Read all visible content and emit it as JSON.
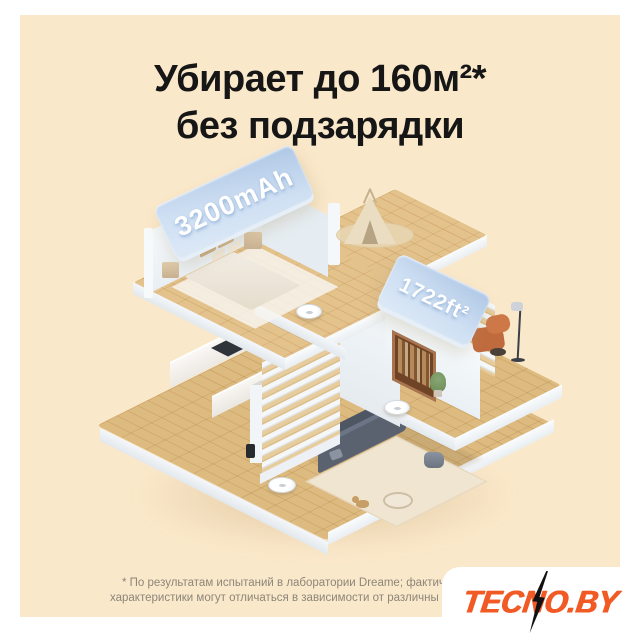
{
  "title": {
    "line1": "Убирает до 160м²*",
    "line2": "без подзарядки"
  },
  "badges": {
    "battery_label": "3200mAh",
    "area_label": "1722ft²"
  },
  "footnote": {
    "line1": "* По результатам испытаний в лаборатории Dreame; фактич",
    "line2": "характеристики могут отличаться в зависимости от различны"
  },
  "watermark": {
    "text": "TECNO.BY"
  },
  "colors": {
    "page": "#FFFFFF",
    "card_background": "#FAE8CA",
    "title_text": "#161616",
    "badge_blue_top": "#AFC7E5",
    "badge_blue_bottom": "#DCE9F7",
    "badge_text": "#FFFFFF",
    "wood_floor": "#DDBA80",
    "wood_floor_upper": "#E4C28C",
    "wall_white": "#F4F8FB",
    "sofa_gray": "#5A6270",
    "rug_beige": "#F0E5D0",
    "bookshelf_brown": "#A9734E",
    "armchair_orange": "#C06B3E",
    "footnote_text": "#8C8679",
    "watermark_orange": "#F15A24",
    "watermark_bolt": "#111111"
  }
}
